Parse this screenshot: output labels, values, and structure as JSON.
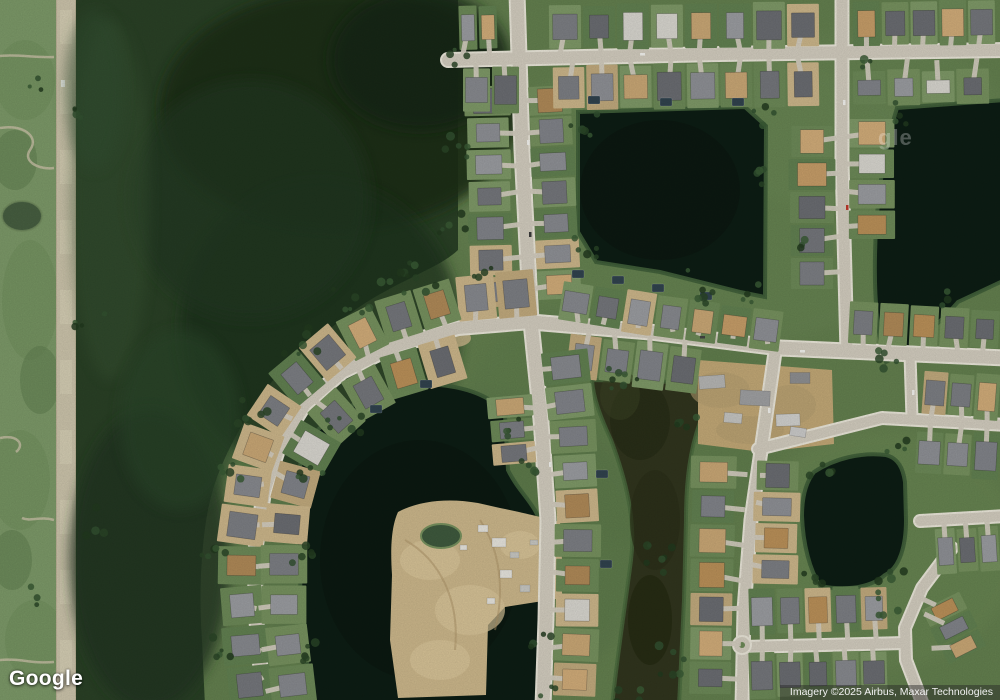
{
  "branding": {
    "logo_text": "Google"
  },
  "watermark": {
    "text": "gle"
  },
  "attribution": {
    "text": "Imagery ©2025 Airbus, Maxar Technologies"
  },
  "map": {
    "description": "Satellite view of a residential lake development bordered by conservation forest and pasture with a dirt road on the west",
    "colors": {
      "dev_base": "#64804f",
      "pasture": "#7d9a69",
      "dirt_road": "#cdc5ac",
      "forest_mid": "#2a4126",
      "forest_dark": "#1b2d19",
      "forest_deep": "#152612",
      "lake": "#0d1d14",
      "lake_deep": "#0a150e",
      "lake_shore": "#41603a",
      "marsh": "#31351e",
      "road": "#d4cec0",
      "road_edge": "#ece8db",
      "sand": "#cdb88c",
      "sand_light": "#dbc79b",
      "pool": "#31434e",
      "roof_grays": [
        "#82848a",
        "#8f9196",
        "#75777c",
        "#9b9da1",
        "#6b6d72",
        "#888a8f",
        "#7d7f84"
      ],
      "roof_tans": [
        "#c79e69",
        "#d2ad7a",
        "#bb9159",
        "#caa876",
        "#b08a58"
      ],
      "roof_slab": "#d9d7d0",
      "lot_greens": [
        "#6d8a58",
        "#77925f",
        "#628151",
        "#7f9a68"
      ],
      "lot_sands": [
        "#c2ab7e",
        "#cdb78b"
      ]
    }
  }
}
